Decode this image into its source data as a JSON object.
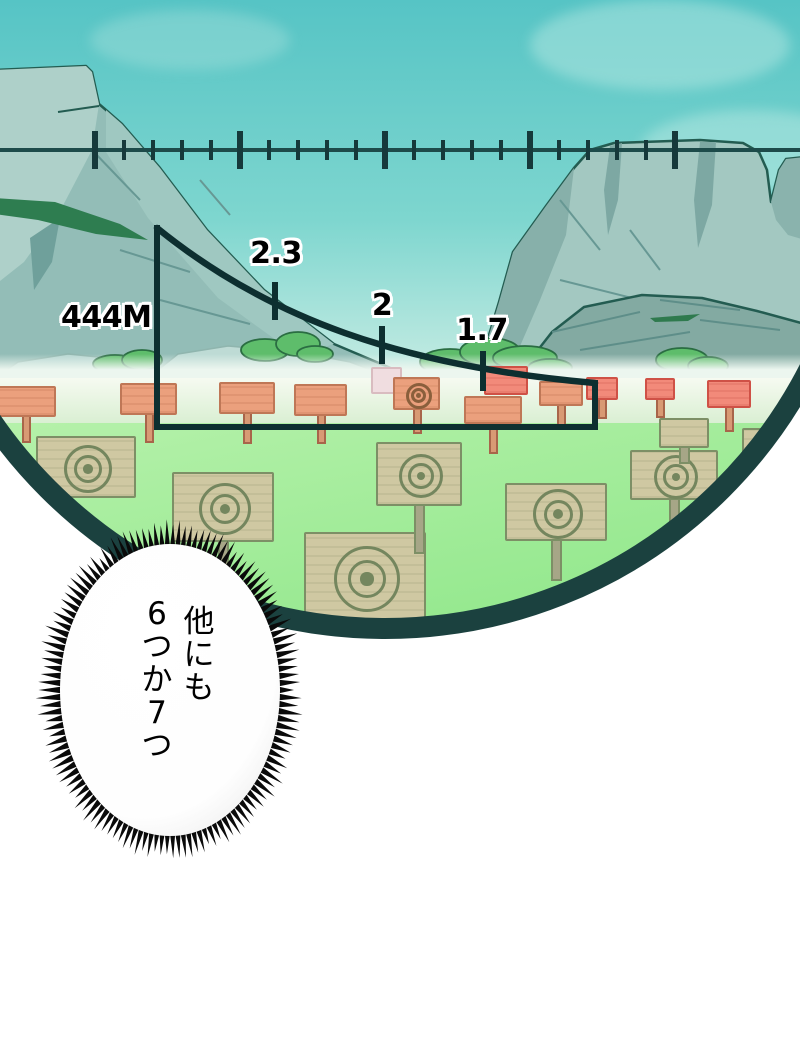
{
  "panel": {
    "kind": "manga sniper-scope view of a target range"
  },
  "scope": {
    "range_label": "444M",
    "bracket": {
      "left_x": 157,
      "top_y": 228,
      "bottom_y": 427,
      "right_x": 595,
      "right_top_y": 383,
      "stroke_w": 6
    },
    "curve": {
      "c1x": 268,
      "c1y": 318,
      "c2x": 400,
      "c2y": 366,
      "stroke_w": 6.5
    },
    "drop_ticks": [
      {
        "label": "2.3",
        "x": 275,
        "tick_top": 282,
        "tick_h": 38,
        "label_cx": 276,
        "label_top": 236
      },
      {
        "label": "2",
        "x": 382,
        "tick_top": 326,
        "tick_h": 38,
        "label_cx": 382,
        "label_top": 288
      },
      {
        "label": "1.7",
        "x": 483,
        "tick_top": 351,
        "tick_h": 40,
        "label_cx": 482,
        "label_top": 313
      }
    ],
    "reticle": {
      "line_y": 148,
      "line_h": 4,
      "tall_xs": [
        95,
        240,
        385,
        530,
        675
      ],
      "tall_h": 38,
      "tall_w": 6,
      "shorts_per_gap": 4,
      "short_h": 20,
      "short_w": 4
    },
    "ring": {
      "cx": 385,
      "cy": 152,
      "inner_r": 466,
      "thickness": 21
    }
  },
  "speech": {
    "lines": [
      "他にも",
      "6つか7つ"
    ]
  },
  "targets": {
    "strip": [
      {
        "x": -4,
        "y": 386,
        "w": 60,
        "h": 31,
        "variant": "salmon",
        "post_h": 26
      },
      {
        "x": 120,
        "y": 383,
        "w": 57,
        "h": 32,
        "variant": "salmon",
        "post_h": 28
      },
      {
        "x": 219,
        "y": 382,
        "w": 56,
        "h": 32,
        "variant": "salmon",
        "post_h": 30
      },
      {
        "x": 294,
        "y": 384,
        "w": 53,
        "h": 32,
        "variant": "salmon",
        "post_h": 28
      },
      {
        "x": 371,
        "y": 367,
        "w": 31,
        "h": 27,
        "variant": "pale",
        "post_h": 0
      },
      {
        "x": 393,
        "y": 377,
        "w": 47,
        "h": 33,
        "variant": "rings",
        "post_h": 24,
        "ring_r": 13
      },
      {
        "x": 464,
        "y": 396,
        "w": 58,
        "h": 28,
        "variant": "salmon",
        "post_h": 30
      },
      {
        "x": 484,
        "y": 366,
        "w": 44,
        "h": 29,
        "variant": "red",
        "post_h": 0
      },
      {
        "x": 539,
        "y": 381,
        "w": 44,
        "h": 25,
        "variant": "salmon",
        "post_h": 22
      },
      {
        "x": 586,
        "y": 377,
        "w": 32,
        "h": 23,
        "variant": "red",
        "post_h": 19
      },
      {
        "x": 645,
        "y": 378,
        "w": 30,
        "h": 22,
        "variant": "red",
        "post_h": 18
      },
      {
        "x": 707,
        "y": 380,
        "w": 44,
        "h": 28,
        "variant": "red",
        "post_h": 24
      }
    ],
    "field": [
      {
        "x": 36,
        "y": 436,
        "w": 100,
        "h": 62,
        "post_h": 0,
        "ring_r": 24
      },
      {
        "x": 172,
        "y": 472,
        "w": 102,
        "h": 70,
        "post_h": 42,
        "ring_r": 26
      },
      {
        "x": 304,
        "y": 532,
        "w": 122,
        "h": 90,
        "post_h": 0,
        "ring_r": 33
      },
      {
        "x": 376,
        "y": 442,
        "w": 86,
        "h": 64,
        "post_h": 48,
        "ring_r": 22
      },
      {
        "x": 505,
        "y": 483,
        "w": 102,
        "h": 58,
        "post_h": 40,
        "ring_r": 25
      },
      {
        "x": 630,
        "y": 450,
        "w": 88,
        "h": 50,
        "post_h": 34,
        "ring_r": 22
      },
      {
        "x": 742,
        "y": 428,
        "w": 62,
        "h": 50,
        "post_h": 20,
        "ring_r": 20
      },
      {
        "x": 659,
        "y": 418,
        "w": 50,
        "h": 30,
        "post_h": 16,
        "ring_r": 0
      }
    ]
  },
  "bubble": {
    "cx": 170,
    "cy": 690,
    "rx": 110,
    "ry": 146,
    "spikes": 130
  },
  "colors": {
    "outside": "#ffffff",
    "ink": "#0d2f30",
    "retLine": "#1d4b4a",
    "retTick": "#16393b",
    "ring": "#1b413f",
    "skyTop": "#56c4c5",
    "skyMid": "#7ed6cf",
    "skyHorizon": "#cdeee5",
    "mtLight": "#aed0c9",
    "mtBase": "#93bdb7",
    "mtMid": "#87b0aa",
    "mtShadow": "#6fa09b",
    "mtLine": "#235c51",
    "rockDistant": "#bedbd5",
    "bush": "#5ebd6b",
    "bushLine": "#2a6d42",
    "greenStreak": "#2e7d50",
    "haze": "#ecf6ef",
    "stripTop": "#f6faf1",
    "stripBot": "#d9efd2",
    "fieldTop": "#b5f1aa",
    "fieldBot": "#8ce687",
    "boardTan": "#cfc8a2",
    "boardLine": "#7d8f66",
    "postTan": "#a6a687",
    "salmon": "#eba07d",
    "salmonDk": "#bf7756",
    "red": "#f28a7a",
    "redDk": "#cf5146",
    "paleBoard": "#f0dde0",
    "bullStroke": "#74865e",
    "stripBullStroke": "#8a5f3c"
  }
}
